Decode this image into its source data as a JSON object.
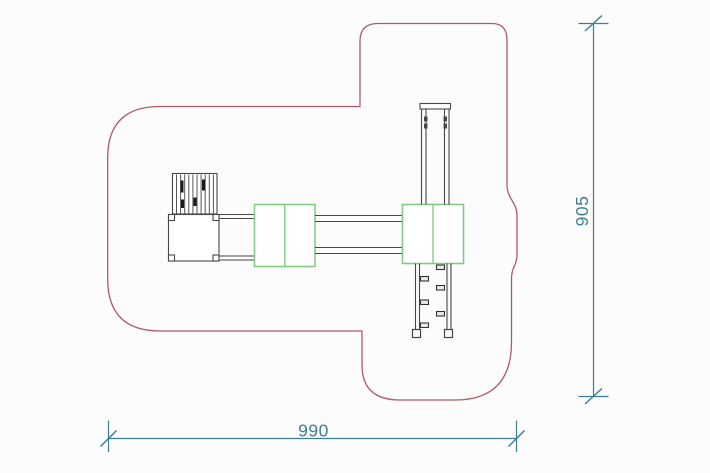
{
  "drawing": {
    "dimensions": {
      "horizontal": {
        "value": "990"
      },
      "vertical": {
        "value": "905"
      }
    },
    "colors": {
      "boundary": "#b05a68",
      "platform": "#85cb85",
      "equipment": "#474747",
      "dimension": "#3f7e92",
      "background": "#fcfcfc"
    }
  }
}
